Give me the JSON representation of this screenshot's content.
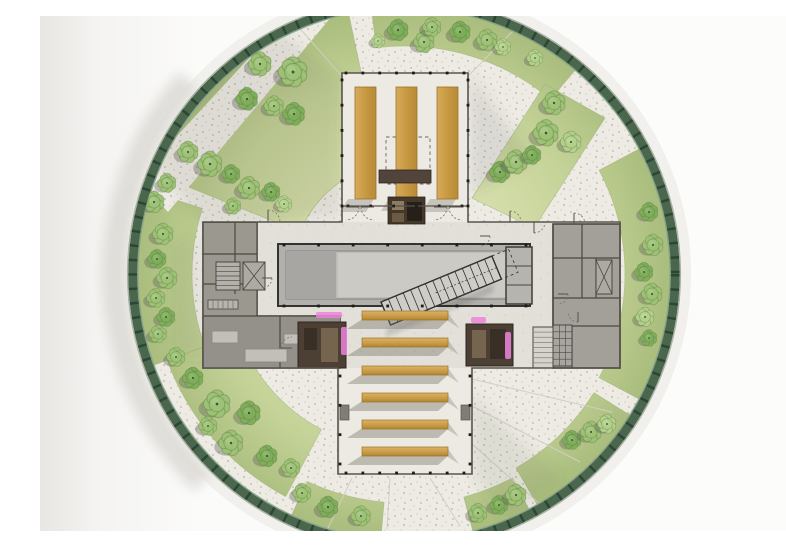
{
  "meta": {
    "description": "Aerial architectural site plan: cruciform building with wooden pews and decks inside a circular glass-rimmed park with trees and radiating stone paths",
    "type": "architectural-floor-plan-render"
  },
  "canvas": {
    "w": 786,
    "h": 515
  },
  "palette": {
    "background": "#fbfbfa",
    "backgroundEdge": "#e8e7e4",
    "paving": "#edebe4",
    "pavingDot": "#c9c3b7",
    "grassInner": "#d8e0ae",
    "grassOuter": "#a9bd7d",
    "ringGreen": "#4a674e",
    "ringTick": "#2c4634",
    "ringRim": "#a9b2a4",
    "concreteArm": "#edeae3",
    "concreteBar": "#e3e0d9",
    "wingGray": "#a3a09a",
    "roomDark": "#929088",
    "hallGray": "#b2b0ac",
    "hallInner": "#bfbdb9",
    "hallLight": "#cccac5",
    "wall": "#4b4843",
    "wallLight": "#8e8b84",
    "wood": "#c99c49",
    "woodLight": "#ddb266",
    "woodEdge": "#9a7427",
    "furnitureBrown": "#4c3f33",
    "furnitureBrownDark": "#2e2620",
    "magenta": "#ee82dd",
    "treeTones": [
      "#9dc275",
      "#7fae5b",
      "#b3d18c"
    ],
    "treeStroke": "#55713c",
    "treeDot": "#2f431f",
    "shadow": "#5a584f",
    "stairTread": "#33312e"
  },
  "site": {
    "cx": 364,
    "cy": 258,
    "rPaving": 266,
    "rRing": 271,
    "rRimOuter": 276.4,
    "rRimInner": 266.2,
    "ringWidth": 9.5,
    "tickDash": "2.5 11.9",
    "crescent": {
      "r": 290,
      "a0": 138,
      "a1": 226,
      "width": 24
    }
  },
  "grass": {
    "sectors": [
      [
        50,
        97,
        228,
        266
      ],
      [
        102,
        158,
        112,
        266
      ],
      [
        162,
        200,
        212,
        266
      ],
      [
        200,
        242,
        176,
        252
      ],
      [
        245,
        265,
        229,
        266
      ],
      [
        285,
        298,
        231,
        266
      ],
      [
        300,
        328,
        224,
        266
      ],
      [
        332,
        388,
        221,
        266
      ]
    ],
    "polys": [
      [
        [
          432,
          182
        ],
        [
          505,
          68
        ],
        [
          565,
          102
        ],
        [
          494,
          212
        ]
      ]
    ],
    "pathQuad": [
      [
        248,
        0
      ],
      [
        292,
        0
      ],
      [
        128,
        196
      ],
      [
        98,
        162
      ]
    ]
  },
  "shadowSwaths": [
    {
      "pts": [
        [
          300,
          62
        ],
        [
          236,
          12
        ],
        [
          92,
          120
        ],
        [
          165,
          212
        ],
        [
          300,
          200
        ]
      ],
      "op": 0.11
    },
    {
      "pts": [
        [
          430,
          58
        ],
        [
          492,
          142
        ],
        [
          430,
          178
        ]
      ],
      "op": 0.12
    },
    {
      "pts": [
        [
          432,
          378
        ],
        [
          522,
          464
        ],
        [
          468,
          502
        ],
        [
          432,
          458
        ]
      ],
      "op": 0.1
    },
    {
      "pts": [
        [
          163,
          212
        ],
        [
          132,
          234
        ],
        [
          132,
          332
        ],
        [
          163,
          346
        ]
      ],
      "op": 0.07
    }
  ],
  "paveLines": [
    [
      312,
      462,
      288,
      512
    ],
    [
      350,
      462,
      347,
      513
    ],
    [
      390,
      462,
      420,
      510
    ],
    [
      432,
      428,
      502,
      490
    ],
    [
      432,
      390,
      540,
      446
    ],
    [
      432,
      363,
      572,
      396
    ],
    [
      302,
      60,
      254,
      6
    ],
    [
      428,
      60,
      482,
      6
    ]
  ],
  "trees": {
    "items": [
      [
        220,
        48,
        1.0,
        0
      ],
      [
        253,
        56,
        1.25,
        0
      ],
      [
        207,
        83,
        0.95,
        1
      ],
      [
        234,
        90,
        0.85,
        0
      ],
      [
        254,
        98,
        0.95,
        1
      ],
      [
        148,
        136,
        0.9,
        0
      ],
      [
        170,
        148,
        1.05,
        0
      ],
      [
        191,
        158,
        0.8,
        1
      ],
      [
        127,
        167,
        0.8,
        0
      ],
      [
        114,
        186,
        0.9,
        0
      ],
      [
        209,
        172,
        0.95,
        0
      ],
      [
        231,
        176,
        0.8,
        1
      ],
      [
        193,
        190,
        0.7,
        0
      ],
      [
        244,
        188,
        0.7,
        2
      ],
      [
        123,
        218,
        0.9,
        0
      ],
      [
        117,
        243,
        0.8,
        1
      ],
      [
        127,
        262,
        0.9,
        0
      ],
      [
        116,
        282,
        0.8,
        0
      ],
      [
        126,
        301,
        0.8,
        1
      ],
      [
        118,
        318,
        0.75,
        0
      ],
      [
        136,
        341,
        0.8,
        0
      ],
      [
        153,
        362,
        0.9,
        1
      ],
      [
        177,
        388,
        1.15,
        0
      ],
      [
        209,
        397,
        1.0,
        1
      ],
      [
        168,
        410,
        0.8,
        0
      ],
      [
        191,
        427,
        1.05,
        0
      ],
      [
        227,
        440,
        0.9,
        1
      ],
      [
        251,
        452,
        0.8,
        0
      ],
      [
        262,
        477,
        0.8,
        0
      ],
      [
        288,
        491,
        0.9,
        1
      ],
      [
        321,
        500,
        0.85,
        0
      ],
      [
        438,
        497,
        0.8,
        0
      ],
      [
        459,
        489,
        0.8,
        1
      ],
      [
        476,
        479,
        0.9,
        0
      ],
      [
        532,
        424,
        0.8,
        1
      ],
      [
        551,
        416,
        0.9,
        0
      ],
      [
        567,
        408,
        0.8,
        2
      ],
      [
        609,
        196,
        0.8,
        1
      ],
      [
        613,
        229,
        0.9,
        0
      ],
      [
        604,
        256,
        0.8,
        1
      ],
      [
        612,
        278,
        0.9,
        0
      ],
      [
        605,
        301,
        0.8,
        2
      ],
      [
        609,
        322,
        0.7,
        1
      ],
      [
        460,
        156,
        0.9,
        1
      ],
      [
        476,
        146,
        1.0,
        0
      ],
      [
        492,
        139,
        0.8,
        1
      ],
      [
        506,
        117,
        1.1,
        0
      ],
      [
        514,
        87,
        1.0,
        0
      ],
      [
        531,
        126,
        0.9,
        2
      ],
      [
        495,
        42,
        0.7,
        2
      ],
      [
        358,
        14,
        0.9,
        1
      ],
      [
        384,
        26,
        0.9,
        0
      ],
      [
        392,
        11,
        0.8,
        0
      ],
      [
        420,
        16,
        0.9,
        1
      ],
      [
        447,
        24,
        0.9,
        0
      ],
      [
        463,
        31,
        0.7,
        2
      ],
      [
        338,
        25,
        0.6,
        2
      ]
    ]
  },
  "building": {
    "outline": "M302,57 H428 V206 H580 V352 H432 V458 H298 V352 H163 V206 H302 Z",
    "barRect": [
      163,
      206,
      417,
      146
    ],
    "topArmRect": [
      302,
      57,
      126,
      149
    ],
    "bottomArmRect": [
      300,
      352,
      130,
      106
    ],
    "armBottomLine": [
      302,
      190,
      428,
      190
    ],
    "skylightDash": [
      346,
      121,
      44,
      47
    ],
    "woodStrips": [
      {
        "x": 315,
        "y": 71,
        "w": 21,
        "h": 112
      },
      {
        "x": 356,
        "y": 71,
        "w": 21,
        "h": 111
      },
      {
        "x": 397,
        "y": 71,
        "w": 21,
        "h": 112
      }
    ],
    "altarBar": [
      339,
      154,
      52,
      13
    ],
    "cabinet": [
      348,
      181,
      37,
      27
    ],
    "cabinetInner": [
      [
        352,
        185,
        12,
        9,
        "#8d7c63"
      ],
      [
        367,
        186,
        15,
        19,
        "#27201a"
      ],
      [
        352,
        197,
        12,
        9,
        "#6b5b45"
      ]
    ],
    "hall": {
      "outer": [
        238,
        228,
        252,
        62
      ],
      "inner": [
        246,
        235,
        236,
        48
      ],
      "leftPanel": [
        246,
        235,
        50,
        48
      ],
      "lightPanel": [
        298,
        237,
        182,
        44
      ],
      "avRoom": [
        466,
        231,
        26,
        57
      ],
      "avLines": [
        [
          466,
          250,
          492,
          250
        ],
        [
          466,
          269,
          492,
          269
        ]
      ],
      "stair": {
        "x": 341,
        "y": 286,
        "len": 120,
        "w": 25,
        "angle": -22.5,
        "treads": 15,
        "dashExt": 18
      }
    },
    "leftWing": {
      "shape": "M163,207 H217 V300 H300 V352 H163 Z",
      "rooms": [
        [
          163,
          207,
          54,
          93,
          "#9b9890"
        ],
        [
          163,
          300,
          137,
          52,
          "#94918a"
        ]
      ],
      "walls": [
        [
          217,
          207,
          217,
          300
        ],
        [
          195,
          207,
          195,
          278
        ],
        [
          163,
          238,
          217,
          238
        ],
        [
          163,
          268,
          217,
          268
        ],
        [
          240,
          300,
          240,
          352
        ],
        [
          163,
          300,
          300,
          300
        ]
      ],
      "stairHatch": [
        176,
        246,
        24,
        28
      ],
      "elevator": [
        203,
        246,
        22,
        28
      ],
      "kitchenTiles": [
        168,
        284,
        30,
        9
      ],
      "furniture": [
        [
          172,
          315,
          26,
          12
        ],
        [
          205,
          333,
          42,
          13
        ],
        [
          244,
          318,
          30,
          10
        ]
      ]
    },
    "rightWing": {
      "rect": [
        513,
        208,
        67,
        144
      ],
      "walls": [
        [
          513,
          208,
          513,
          352
        ],
        [
          542,
          208,
          542,
          282
        ],
        [
          513,
          242,
          580,
          242
        ],
        [
          513,
          282,
          580,
          282
        ],
        [
          556,
          242,
          556,
          282
        ],
        [
          532,
          310,
          580,
          310
        ],
        [
          532,
          310,
          532,
          352
        ]
      ],
      "shaftX": [
        556,
        244,
        16,
        34
      ],
      "ramp": [
        493,
        311,
        20,
        41
      ],
      "lockers": [
        513,
        309,
        19,
        41
      ]
    },
    "darkBlocks": [
      {
        "rect": [
          258,
          306,
          48,
          46
        ],
        "inner": [
          [
            264,
            312,
            13,
            22,
            "#3a2f26"
          ],
          [
            281,
            312,
            17,
            34,
            "#75644e"
          ]
        ]
      },
      {
        "rect": [
          426,
          308,
          47,
          42
        ],
        "inner": [
          [
            432,
            314,
            14,
            28,
            "#75644e"
          ],
          [
            450,
            313,
            16,
            30,
            "#3a2f26"
          ]
        ]
      }
    ],
    "magentaAccents": [
      [
        276,
        296,
        26,
        6
      ],
      [
        301,
        311,
        6,
        28
      ],
      [
        431,
        301,
        15,
        6
      ],
      [
        465,
        316,
        6,
        27
      ]
    ],
    "grayTabs": [
      [
        300,
        389,
        9,
        15
      ],
      [
        421,
        389,
        9,
        15
      ]
    ],
    "benches": {
      "x": 322,
      "w": 86,
      "h": 9,
      "ys": [
        295,
        322,
        350,
        377,
        404,
        431
      ]
    },
    "columnDotEdges": [
      [
        306,
        57,
        424,
        57,
        8
      ],
      [
        302,
        64,
        302,
        190,
        6
      ],
      [
        428,
        64,
        428,
        190,
        6
      ],
      [
        308,
        190,
        422,
        190,
        6
      ],
      [
        244,
        229,
        486,
        229,
        8
      ],
      [
        244,
        290,
        486,
        290,
        8
      ],
      [
        300,
        360,
        300,
        448,
        4
      ],
      [
        430,
        360,
        430,
        448,
        4
      ],
      [
        306,
        457,
        424,
        457,
        8
      ]
    ],
    "doors": [
      [
        306,
        191,
        13,
        0,
        0
      ],
      [
        334,
        191,
        13,
        0,
        1
      ],
      [
        394,
        191,
        13,
        0,
        0
      ],
      [
        422,
        191,
        13,
        0,
        1
      ],
      [
        228,
        206,
        12,
        -90,
        0
      ],
      [
        470,
        206,
        11,
        -90,
        0
      ],
      [
        494,
        206,
        11,
        -90,
        1
      ],
      [
        534,
        208,
        11,
        -90,
        0
      ],
      [
        440,
        220,
        10,
        0,
        0
      ],
      [
        518,
        278,
        10,
        0,
        0
      ],
      [
        538,
        296,
        10,
        90,
        0
      ],
      [
        222,
        262,
        10,
        0,
        0
      ],
      [
        252,
        332,
        11,
        180,
        0
      ]
    ]
  }
}
